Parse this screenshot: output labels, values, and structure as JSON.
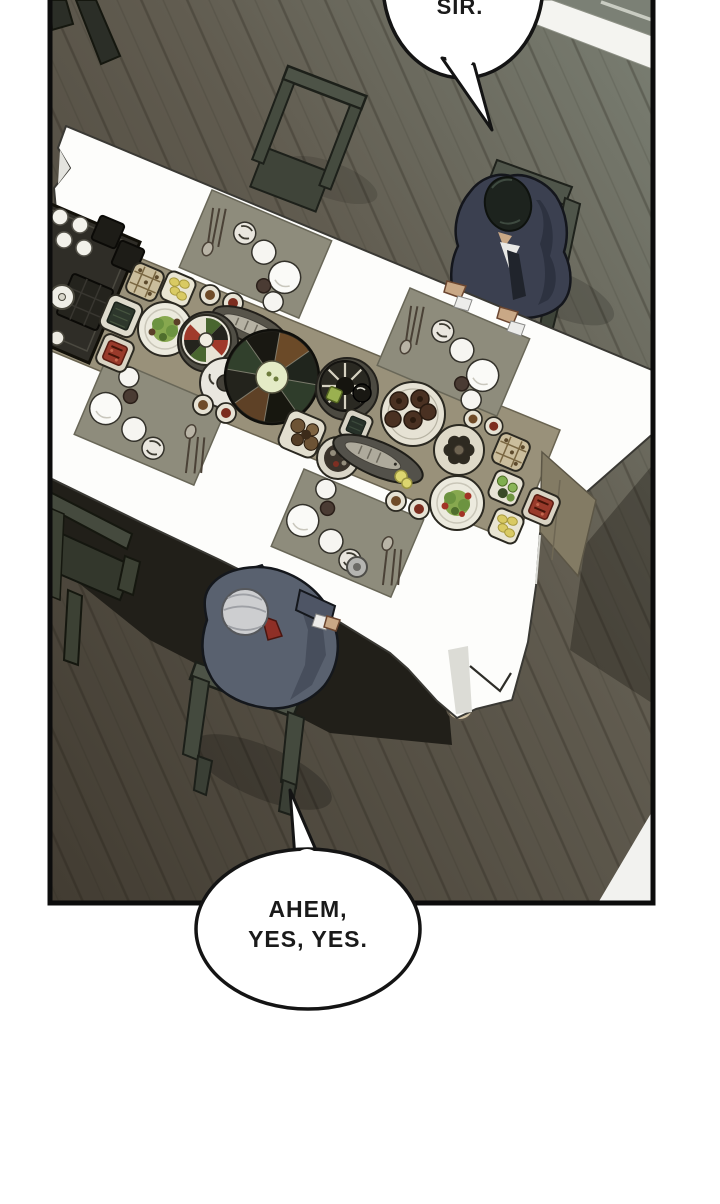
{
  "scene": {
    "type": "webtoon-panel",
    "description": "Top-down view of a formal dining room: two men in suits sit at opposite ends of a long white-clothed table set with a Korean banquet spread on a dark wood floor.",
    "characters": [
      {
        "id": "man-black-hair",
        "position": "top-right",
        "appearance": "black hair, dark navy suit, head bowed, seated on wooden chair"
      },
      {
        "id": "man-silver-hair",
        "position": "bottom-left",
        "appearance": "silver hair, slate-gray suit, red tie, seated on wooden chair"
      }
    ]
  },
  "speech": {
    "top_bubble": {
      "speaker": "man-black-hair",
      "text": "SIR."
    },
    "bottom_bubble": {
      "speaker": "man-silver-hair",
      "line1": "AHEM,",
      "line2": "YES, YES."
    }
  },
  "colors": {
    "page_background": "#ffffff",
    "panel_border": "#0c0c0c",
    "floor_light": "#7a7f73",
    "floor_mid": "#615c50",
    "floor_dark": "#423c32",
    "wall_baseboard": "#f4f4f0",
    "wall_upper": "#7b8075",
    "tablecloth": "#fdfdfb",
    "table_runner": "#99917a",
    "placemat": "#8e8c7c",
    "tray": "#2f2d27",
    "chair_wood": "#4d5347",
    "suit_navy": "#3b4050",
    "suit_slate": "#59616f",
    "hair_black": "#1d231e",
    "hair_silver": "#cdced0",
    "tie_red": "#8e2f26",
    "skin": "#c9a886"
  }
}
